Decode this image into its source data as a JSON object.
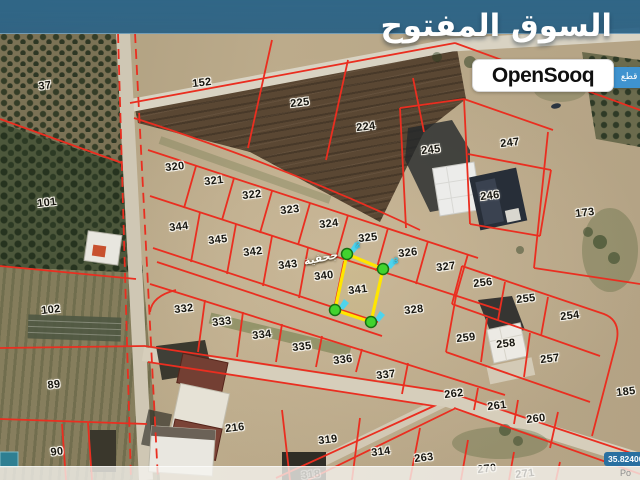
{
  "branding": {
    "logo_arabic": "السوق المفتوح",
    "logo_latin": "OpenSooq",
    "side_badge_arabic": "اء قطع",
    "coords_label": "35.82400,3",
    "powered_by_partial": "Po"
  },
  "colors": {
    "boundary_red": "#ea2e20",
    "highlight_yellow": "#ffe600",
    "vertex_green": "#41d32e",
    "marker_cyan": "#49d6f2",
    "brand_bar_blue": "#2b6487",
    "badge_blue": "#3f93cf",
    "coord_bg": "#2a70a0"
  },
  "map": {
    "place_label": "جحفية",
    "highlight": {
      "parcel": "341",
      "marker_labels": [
        {
          "t": "2",
          "x": 358,
          "y": 245
        },
        {
          "t": "3",
          "x": 396,
          "y": 261
        }
      ]
    },
    "parcels": [
      {
        "label": "37",
        "x": 45,
        "y": 86
      },
      {
        "label": "101",
        "x": 47,
        "y": 203
      },
      {
        "label": "102",
        "x": 51,
        "y": 310
      },
      {
        "label": "89",
        "x": 54,
        "y": 385
      },
      {
        "label": "90",
        "x": 57,
        "y": 452
      },
      {
        "label": "152",
        "x": 202,
        "y": 83
      },
      {
        "label": "225",
        "x": 300,
        "y": 103
      },
      {
        "label": "224",
        "x": 366,
        "y": 127
      },
      {
        "label": "245",
        "x": 431,
        "y": 150
      },
      {
        "label": "247",
        "x": 510,
        "y": 143
      },
      {
        "label": "246",
        "x": 490,
        "y": 196
      },
      {
        "label": "173",
        "x": 585,
        "y": 213
      },
      {
        "label": "320",
        "x": 175,
        "y": 167
      },
      {
        "label": "321",
        "x": 214,
        "y": 181
      },
      {
        "label": "322",
        "x": 252,
        "y": 195
      },
      {
        "label": "323",
        "x": 290,
        "y": 210
      },
      {
        "label": "324",
        "x": 329,
        "y": 224
      },
      {
        "label": "325",
        "x": 368,
        "y": 238
      },
      {
        "label": "326",
        "x": 408,
        "y": 253
      },
      {
        "label": "327",
        "x": 446,
        "y": 267
      },
      {
        "label": "344",
        "x": 179,
        "y": 227
      },
      {
        "label": "345",
        "x": 218,
        "y": 240
      },
      {
        "label": "342",
        "x": 253,
        "y": 252
      },
      {
        "label": "343",
        "x": 288,
        "y": 265
      },
      {
        "label": "340",
        "x": 324,
        "y": 276
      },
      {
        "label": "341",
        "x": 358,
        "y": 290
      },
      {
        "label": "328",
        "x": 414,
        "y": 310
      },
      {
        "label": "332",
        "x": 184,
        "y": 309
      },
      {
        "label": "333",
        "x": 222,
        "y": 322
      },
      {
        "label": "334",
        "x": 262,
        "y": 335
      },
      {
        "label": "335",
        "x": 302,
        "y": 347
      },
      {
        "label": "336",
        "x": 343,
        "y": 360
      },
      {
        "label": "337",
        "x": 386,
        "y": 375
      },
      {
        "label": "256",
        "x": 483,
        "y": 283
      },
      {
        "label": "255",
        "x": 526,
        "y": 299
      },
      {
        "label": "254",
        "x": 570,
        "y": 316
      },
      {
        "label": "259",
        "x": 466,
        "y": 338
      },
      {
        "label": "258",
        "x": 506,
        "y": 344
      },
      {
        "label": "257",
        "x": 550,
        "y": 359
      },
      {
        "label": "185",
        "x": 626,
        "y": 392
      },
      {
        "label": "262",
        "x": 454,
        "y": 394
      },
      {
        "label": "261",
        "x": 497,
        "y": 406
      },
      {
        "label": "260",
        "x": 536,
        "y": 419
      },
      {
        "label": "216",
        "x": 235,
        "y": 428
      },
      {
        "label": "319",
        "x": 328,
        "y": 440
      },
      {
        "label": "314",
        "x": 381,
        "y": 452
      },
      {
        "label": "263",
        "x": 424,
        "y": 458
      },
      {
        "label": "270",
        "x": 487,
        "y": 469
      },
      {
        "label": "271",
        "x": 525,
        "y": 474
      },
      {
        "label": "318",
        "x": 311,
        "y": 475,
        "faded": true
      }
    ]
  }
}
